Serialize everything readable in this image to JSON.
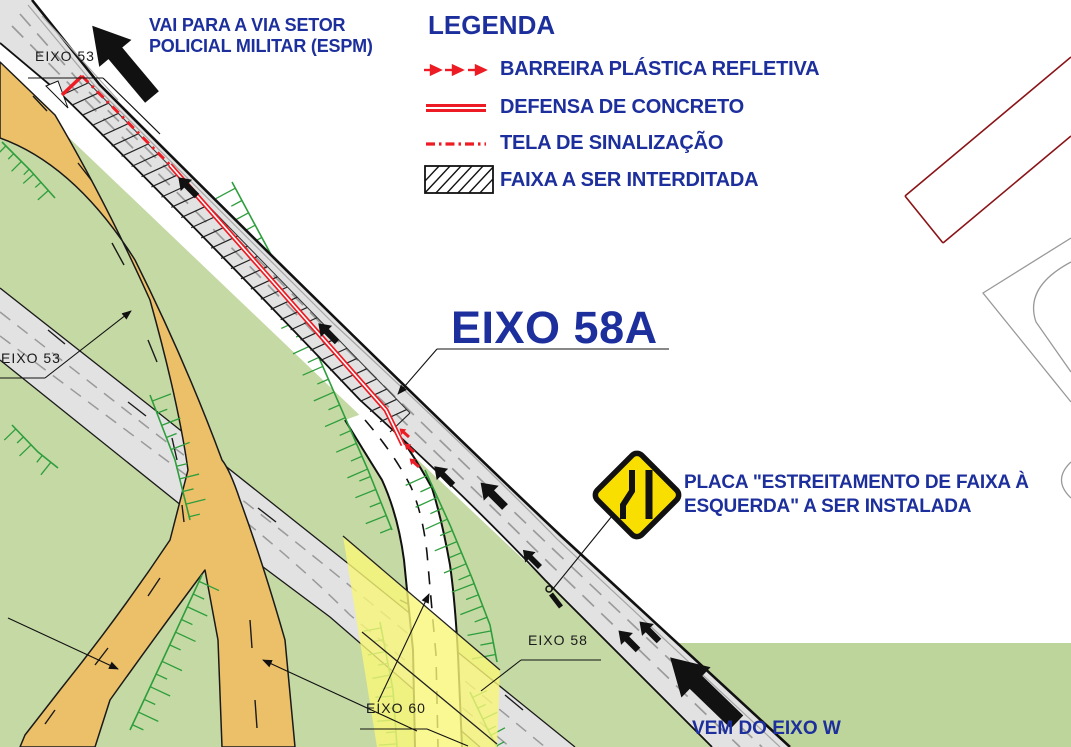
{
  "colors": {
    "blue": "#1c2f9c",
    "red": "#ed1c24",
    "dark_red": "#8a1417",
    "road_gray": "#e2e2e2",
    "lane_gray": "#9a9a9a",
    "green_fill": "#c5d9a4",
    "green_fill_dark": "#bdd49a",
    "hatch_green": "#2e9e3c",
    "orange": "#ecc069",
    "sign_yellow": "#f8df00",
    "highlight_yellow": "#f9f678",
    "ink": "#111111"
  },
  "notes": {
    "destination": {
      "line1": "VAI PARA A VIA SETOR",
      "line2": "POLICIAL MILITAR (ESPM)"
    },
    "sign": {
      "line1": "PLACA \"ESTREITAMENTO DE FAIXA À",
      "line2": "ESQUERDA\" A SER INSTALADA"
    },
    "origin": "VEM DO EIXO W"
  },
  "legend": {
    "title": "LEGENDA",
    "items": [
      {
        "id": "barreira",
        "symbol": "red-barrier-arrows-icon",
        "label": "BARREIRA PLÁSTICA REFLETIVA"
      },
      {
        "id": "defensa",
        "symbol": "red-double-line-icon",
        "label": "DEFENSA DE CONCRETO"
      },
      {
        "id": "tela",
        "symbol": "red-dashdot-line-icon",
        "label": "TELA DE SINALIZAÇÃO"
      },
      {
        "id": "faixa",
        "symbol": "hatched-box-icon",
        "label": "FAIXA A SER INTERDITADA"
      }
    ]
  },
  "axes": {
    "eixo53_top": "EIXO 53",
    "eixo53_west": "EIXO 53",
    "eixo58a": "EIXO 58A",
    "eixo58": "EIXO 58",
    "eixo60": "EIXO 60"
  }
}
